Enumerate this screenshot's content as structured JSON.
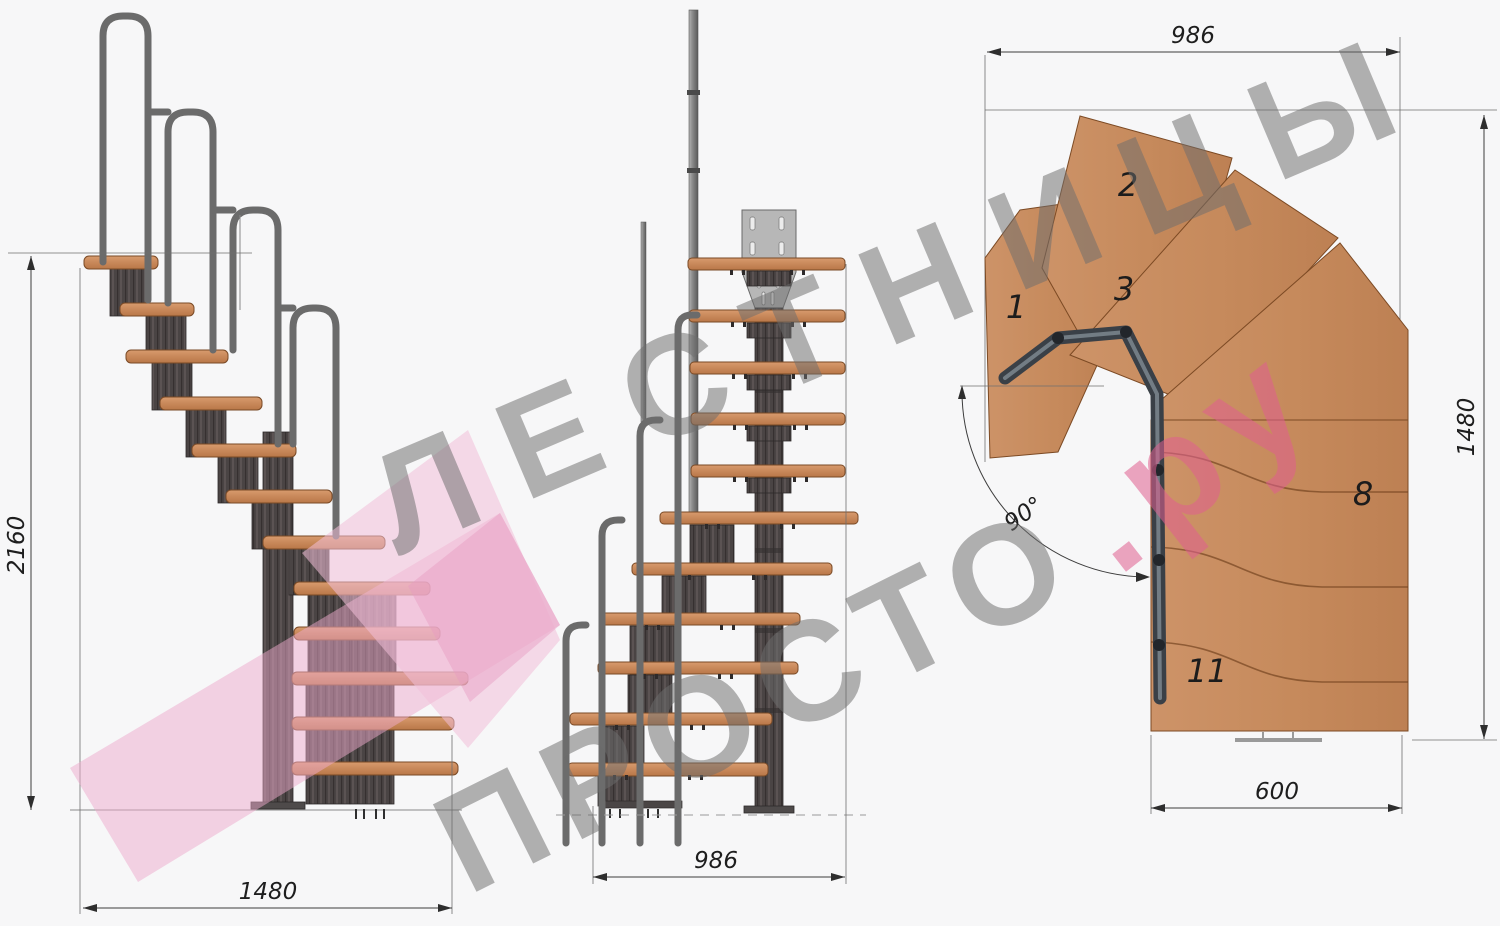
{
  "watermark": {
    "line1": "ЛЕСТНИЦЫ",
    "line2_main": "ПРОСТО",
    "line2_suffix": ".ру",
    "gray": "#6e6e6e",
    "pink": "#e05f90",
    "logo_pink": "#f3c0d8"
  },
  "side_view": {
    "height_label": "2160",
    "width_label": "1480"
  },
  "front_view": {
    "width_label": "986"
  },
  "plan_view": {
    "top_width_label": "986",
    "height_label": "1480",
    "flight_width_label": "600",
    "turn_angle_label": "90°",
    "steps": {
      "s1": "1",
      "s2": "2",
      "s3": "3",
      "s8": "8",
      "s11": "11"
    }
  },
  "colors": {
    "background": "#f7f7f8",
    "wood": "#c8885a",
    "steel_module": "#4a4444",
    "rail": "#6b6b6b",
    "dimension": "#3c3c3c"
  }
}
